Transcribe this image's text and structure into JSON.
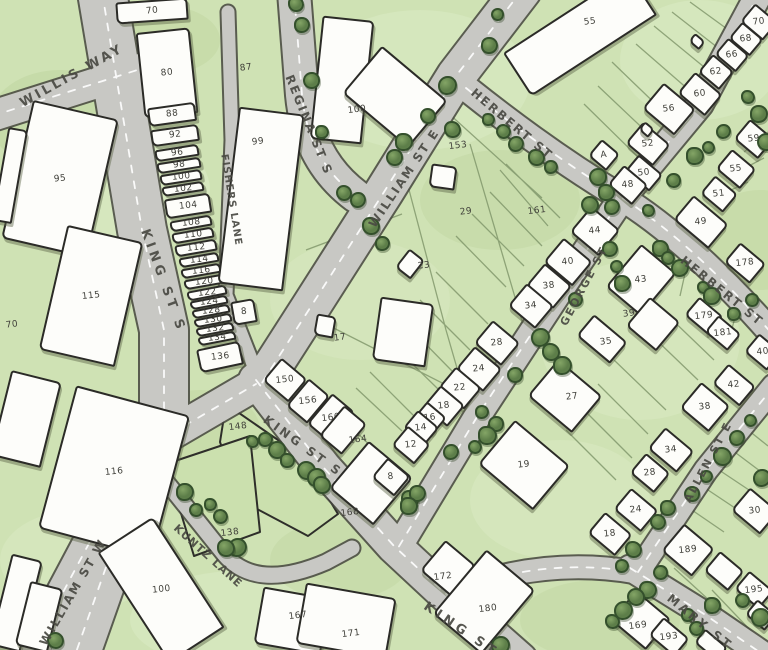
{
  "map": {
    "colors": {
      "background": "#cfe2b4",
      "grass_light": "#dcebc6",
      "grass_dark": "#bed49e",
      "road_fill": "#c8c8c4",
      "road_casing": "#45453e",
      "road_dash": "#ffffff",
      "lot_line": "#7d9468",
      "building_fill": "#fdfdfa",
      "building_outline": "#2b2b27",
      "tree_fill": "#5d7e49",
      "tree_outline": "#34502c",
      "number_label": "#3f3f39",
      "street_label": "#4a4a43"
    },
    "street_labels": [
      {
        "text": "WILLIS WAY",
        "x": 72,
        "y": 76,
        "rot": -29,
        "size": 13,
        "spacing": 3
      },
      {
        "text": "KING ST S",
        "x": 163,
        "y": 281,
        "rot": 70,
        "size": 13,
        "spacing": 4
      },
      {
        "text": "FISHERS LANE",
        "x": 231,
        "y": 200,
        "rot": 81,
        "size": 10,
        "spacing": 1
      },
      {
        "text": "REGINA ST S",
        "x": 309,
        "y": 125,
        "rot": 68,
        "size": 12,
        "spacing": 2
      },
      {
        "text": "WILLIAM ST E",
        "x": 404,
        "y": 178,
        "rot": -56,
        "size": 12,
        "spacing": 2
      },
      {
        "text": "HERBERT ST",
        "x": 512,
        "y": 124,
        "rot": 40,
        "size": 12,
        "spacing": 2
      },
      {
        "text": "HERBERT ST",
        "x": 722,
        "y": 291,
        "rot": 39,
        "size": 12,
        "spacing": 2
      },
      {
        "text": "GEORGE ST",
        "x": 584,
        "y": 286,
        "rot": -62,
        "size": 11,
        "spacing": 2
      },
      {
        "text": "KING ST S",
        "x": 303,
        "y": 446,
        "rot": 36,
        "size": 12,
        "spacing": 3
      },
      {
        "text": "KING ST S",
        "x": 470,
        "y": 636,
        "rot": 34,
        "size": 13,
        "spacing": 4
      },
      {
        "text": "ALLEN ST E",
        "x": 708,
        "y": 462,
        "rot": -62,
        "size": 11,
        "spacing": 2
      },
      {
        "text": "MARY ST",
        "x": 700,
        "y": 622,
        "rot": 39,
        "size": 12,
        "spacing": 3
      },
      {
        "text": "WILLIAM ST W",
        "x": 73,
        "y": 592,
        "rot": -60,
        "size": 12,
        "spacing": 2
      },
      {
        "text": "KUNTZ LANE",
        "x": 208,
        "y": 556,
        "rot": 42,
        "size": 11,
        "spacing": 1
      }
    ],
    "parcel_labels": [
      {
        "text": "70",
        "x": 12,
        "y": 325
      },
      {
        "text": "87",
        "x": 246,
        "y": 68
      },
      {
        "text": "29",
        "x": 466,
        "y": 212
      },
      {
        "text": "153",
        "x": 458,
        "y": 146
      },
      {
        "text": "161",
        "x": 537,
        "y": 211
      },
      {
        "text": "148",
        "x": 238,
        "y": 427
      },
      {
        "text": "138",
        "x": 230,
        "y": 533
      },
      {
        "text": "164",
        "x": 358,
        "y": 440
      }
    ],
    "buildings": [
      {
        "x": 116,
        "y": 0,
        "w": 72,
        "h": 22,
        "r": -4,
        "n": "70"
      },
      {
        "x": 140,
        "y": 30,
        "w": 54,
        "h": 86,
        "r": -6,
        "n": "80"
      },
      {
        "x": 148,
        "y": 105,
        "w": 48,
        "h": 19,
        "r": -8,
        "n": "88"
      },
      {
        "x": 151,
        "y": 127,
        "w": 48,
        "h": 17,
        "r": -8,
        "n": "92"
      },
      {
        "x": 155,
        "y": 147,
        "w": 44,
        "h": 12,
        "r": -9,
        "n": "96"
      },
      {
        "x": 157,
        "y": 160,
        "w": 44,
        "h": 11,
        "r": -9,
        "n": "98"
      },
      {
        "x": 160,
        "y": 172,
        "w": 42,
        "h": 11,
        "r": -9,
        "n": "100"
      },
      {
        "x": 162,
        "y": 184,
        "w": 42,
        "h": 10,
        "r": -9,
        "n": "102"
      },
      {
        "x": 165,
        "y": 196,
        "w": 46,
        "h": 20,
        "r": -9,
        "n": "104"
      },
      {
        "x": 170,
        "y": 218,
        "w": 42,
        "h": 11,
        "r": -10,
        "n": "108"
      },
      {
        "x": 172,
        "y": 230,
        "w": 42,
        "h": 11,
        "r": -10,
        "n": "110"
      },
      {
        "x": 175,
        "y": 242,
        "w": 42,
        "h": 12,
        "r": -10,
        "n": "112"
      },
      {
        "x": 179,
        "y": 255,
        "w": 40,
        "h": 10,
        "r": -10,
        "n": "114"
      },
      {
        "x": 181,
        "y": 266,
        "w": 40,
        "h": 10,
        "r": -10,
        "n": "116"
      },
      {
        "x": 184,
        "y": 277,
        "w": 40,
        "h": 10,
        "r": -10,
        "n": "120"
      },
      {
        "x": 187,
        "y": 288,
        "w": 40,
        "h": 10,
        "r": -11,
        "n": "122"
      },
      {
        "x": 190,
        "y": 298,
        "w": 38,
        "h": 9,
        "r": -11,
        "n": "124"
      },
      {
        "x": 192,
        "y": 307,
        "w": 38,
        "h": 9,
        "r": -11,
        "n": "128"
      },
      {
        "x": 194,
        "y": 316,
        "w": 38,
        "h": 9,
        "r": -11,
        "n": "130"
      },
      {
        "x": 196,
        "y": 325,
        "w": 38,
        "h": 9,
        "r": -11,
        "n": "132"
      },
      {
        "x": 198,
        "y": 334,
        "w": 38,
        "h": 9,
        "r": -11,
        "n": "134"
      },
      {
        "x": 198,
        "y": 345,
        "w": 44,
        "h": 24,
        "r": -12,
        "n": "136"
      },
      {
        "x": 232,
        "y": 300,
        "w": 24,
        "h": 24,
        "r": -10,
        "n": "8"
      },
      {
        "x": 16,
        "y": 108,
        "w": 88,
        "h": 142,
        "r": 13,
        "n": "95"
      },
      {
        "x": 52,
        "y": 232,
        "w": 78,
        "h": 128,
        "r": 13,
        "n": "115"
      },
      {
        "x": 0,
        "y": 128,
        "w": 20,
        "h": 95,
        "r": 10
      },
      {
        "x": 0,
        "y": 375,
        "w": 52,
        "h": 88,
        "r": 14
      },
      {
        "x": 55,
        "y": 398,
        "w": 118,
        "h": 148,
        "r": 15,
        "n": "116"
      },
      {
        "x": 128,
        "y": 524,
        "w": 66,
        "h": 132,
        "r": -33,
        "n": "100"
      },
      {
        "x": 0,
        "y": 556,
        "w": 32,
        "h": 94,
        "r": 14
      },
      {
        "x": 22,
        "y": 584,
        "w": 34,
        "h": 66,
        "r": 14
      },
      {
        "x": 228,
        "y": 110,
        "w": 66,
        "h": 178,
        "r": 7,
        "n": "99",
        "lx": 258,
        "ly": 142
      },
      {
        "x": 316,
        "y": 18,
        "w": 52,
        "h": 124,
        "r": 6,
        "n": "100",
        "lx": 357,
        "ly": 110
      },
      {
        "x": 352,
        "y": 66,
        "w": 86,
        "h": 62,
        "r": 40
      },
      {
        "x": 505,
        "y": 8,
        "w": 150,
        "h": 52,
        "r": -33,
        "n": "55",
        "lx": 590,
        "ly": 22
      },
      {
        "x": 430,
        "y": 165,
        "w": 26,
        "h": 24,
        "r": 8
      },
      {
        "x": 400,
        "y": 252,
        "w": 20,
        "h": 24,
        "r": 38,
        "n": "23",
        "lx": 424,
        "ly": 266
      },
      {
        "x": 315,
        "y": 315,
        "w": 20,
        "h": 22,
        "r": 10,
        "n": "17",
        "lx": 340,
        "ly": 338
      },
      {
        "x": 376,
        "y": 300,
        "w": 54,
        "h": 64,
        "r": 8
      },
      {
        "x": 268,
        "y": 365,
        "w": 34,
        "h": 30,
        "r": 40,
        "n": "150"
      },
      {
        "x": 294,
        "y": 383,
        "w": 28,
        "h": 36,
        "r": 40,
        "n": "156"
      },
      {
        "x": 316,
        "y": 398,
        "w": 30,
        "h": 40,
        "r": 40,
        "n": "160"
      },
      {
        "x": 328,
        "y": 410,
        "w": 30,
        "h": 40,
        "r": 40
      },
      {
        "x": 342,
        "y": 452,
        "w": 58,
        "h": 62,
        "r": 40,
        "n": "168",
        "lx": 350,
        "ly": 513
      },
      {
        "x": 428,
        "y": 548,
        "w": 40,
        "h": 40,
        "r": 40,
        "n": "172",
        "lx": 443,
        "ly": 577
      },
      {
        "x": 452,
        "y": 560,
        "w": 64,
        "h": 84,
        "r": 40,
        "n": "180",
        "lx": 488,
        "ly": 609
      },
      {
        "x": 258,
        "y": 592,
        "w": 68,
        "h": 58,
        "r": 10,
        "n": "167",
        "lx": 298,
        "ly": 616
      },
      {
        "x": 300,
        "y": 590,
        "w": 92,
        "h": 62,
        "r": 10,
        "n": "171",
        "lx": 351,
        "ly": 634
      },
      {
        "x": 576,
        "y": 214,
        "w": 38,
        "h": 34,
        "r": 40,
        "n": "44"
      },
      {
        "x": 549,
        "y": 246,
        "w": 38,
        "h": 32,
        "r": 40,
        "n": "40"
      },
      {
        "x": 531,
        "y": 271,
        "w": 36,
        "h": 30,
        "r": 40,
        "n": "38"
      },
      {
        "x": 513,
        "y": 291,
        "w": 36,
        "h": 30,
        "r": 40,
        "n": "34"
      },
      {
        "x": 479,
        "y": 328,
        "w": 36,
        "h": 30,
        "r": 40,
        "n": "28"
      },
      {
        "x": 461,
        "y": 354,
        "w": 36,
        "h": 30,
        "r": 40,
        "n": "24"
      },
      {
        "x": 443,
        "y": 374,
        "w": 34,
        "h": 28,
        "r": 40,
        "n": "22"
      },
      {
        "x": 428,
        "y": 392,
        "w": 32,
        "h": 28,
        "r": 40,
        "n": "18"
      },
      {
        "x": 417,
        "y": 407,
        "w": 26,
        "h": 22,
        "r": 40,
        "n": "16"
      },
      {
        "x": 407,
        "y": 416,
        "w": 28,
        "h": 24,
        "r": 40,
        "n": "14"
      },
      {
        "x": 396,
        "y": 432,
        "w": 30,
        "h": 26,
        "r": 40,
        "n": "12"
      },
      {
        "x": 376,
        "y": 464,
        "w": 30,
        "h": 26,
        "r": 40,
        "n": "8"
      },
      {
        "x": 488,
        "y": 436,
        "w": 72,
        "h": 58,
        "r": 40,
        "n": "19"
      },
      {
        "x": 618,
        "y": 252,
        "w": 46,
        "h": 56,
        "r": 40,
        "n": "43"
      },
      {
        "x": 633,
        "y": 305,
        "w": 40,
        "h": 38,
        "r": 40,
        "n": "39",
        "lx": 629,
        "ly": 314
      },
      {
        "x": 580,
        "y": 325,
        "w": 44,
        "h": 28,
        "r": 40,
        "n": "35",
        "lx": 606,
        "ly": 342
      },
      {
        "x": 536,
        "y": 372,
        "w": 58,
        "h": 48,
        "r": 40,
        "n": "27",
        "lx": 572,
        "ly": 397
      },
      {
        "x": 744,
        "y": 10,
        "w": 30,
        "h": 24,
        "r": 40,
        "n": "70"
      },
      {
        "x": 732,
        "y": 28,
        "w": 28,
        "h": 22,
        "r": 40,
        "n": "68"
      },
      {
        "x": 718,
        "y": 44,
        "w": 28,
        "h": 22,
        "r": 40,
        "n": "66"
      },
      {
        "x": 702,
        "y": 60,
        "w": 28,
        "h": 24,
        "r": 40,
        "n": "62"
      },
      {
        "x": 682,
        "y": 80,
        "w": 36,
        "h": 28,
        "r": 40,
        "n": "60"
      },
      {
        "x": 648,
        "y": 92,
        "w": 42,
        "h": 34,
        "r": 40,
        "n": "56"
      },
      {
        "x": 630,
        "y": 130,
        "w": 36,
        "h": 28,
        "r": 40,
        "n": "52"
      },
      {
        "x": 628,
        "y": 162,
        "w": 32,
        "h": 22,
        "r": 40,
        "n": "50"
      },
      {
        "x": 612,
        "y": 172,
        "w": 32,
        "h": 26,
        "r": 40,
        "n": "48"
      },
      {
        "x": 738,
        "y": 126,
        "w": 32,
        "h": 26,
        "r": 40,
        "n": "59"
      },
      {
        "x": 720,
        "y": 156,
        "w": 32,
        "h": 26,
        "r": 40,
        "n": "55"
      },
      {
        "x": 704,
        "y": 182,
        "w": 30,
        "h": 24,
        "r": 40,
        "n": "51"
      },
      {
        "x": 690,
        "y": 36,
        "w": 14,
        "h": 11,
        "r": 40
      },
      {
        "x": 640,
        "y": 124,
        "w": 13,
        "h": 11,
        "r": 40
      },
      {
        "x": 592,
        "y": 144,
        "w": 24,
        "h": 22,
        "r": 40,
        "n": "A"
      },
      {
        "x": 678,
        "y": 206,
        "w": 46,
        "h": 32,
        "r": 40,
        "n": "49"
      },
      {
        "x": 728,
        "y": 250,
        "w": 34,
        "h": 26,
        "r": 40,
        "n": "178"
      },
      {
        "x": 688,
        "y": 304,
        "w": 32,
        "h": 24,
        "r": 40,
        "n": "179"
      },
      {
        "x": 708,
        "y": 322,
        "w": 30,
        "h": 22,
        "r": 40,
        "n": "181"
      },
      {
        "x": 748,
        "y": 340,
        "w": 30,
        "h": 24,
        "r": 40,
        "n": "40"
      },
      {
        "x": 716,
        "y": 372,
        "w": 36,
        "h": 26,
        "r": 40,
        "n": "42"
      },
      {
        "x": 686,
        "y": 390,
        "w": 38,
        "h": 34,
        "r": 40,
        "n": "38"
      },
      {
        "x": 652,
        "y": 436,
        "w": 38,
        "h": 28,
        "r": 40,
        "n": "34"
      },
      {
        "x": 634,
        "y": 460,
        "w": 32,
        "h": 26,
        "r": 40,
        "n": "28"
      },
      {
        "x": 736,
        "y": 496,
        "w": 38,
        "h": 30,
        "r": 40,
        "n": "30"
      },
      {
        "x": 618,
        "y": 496,
        "w": 36,
        "h": 28,
        "r": 40,
        "n": "24"
      },
      {
        "x": 592,
        "y": 520,
        "w": 36,
        "h": 28,
        "r": 40,
        "n": "18"
      },
      {
        "x": 668,
        "y": 532,
        "w": 40,
        "h": 36,
        "r": 40,
        "n": "189"
      },
      {
        "x": 708,
        "y": 558,
        "w": 32,
        "h": 26,
        "r": 40
      },
      {
        "x": 738,
        "y": 578,
        "w": 32,
        "h": 24,
        "r": 40,
        "n": "195"
      },
      {
        "x": 618,
        "y": 600,
        "w": 46,
        "h": 40,
        "r": 40,
        "n": "169",
        "lx": 638,
        "ly": 626
      },
      {
        "x": 652,
        "y": 625,
        "w": 34,
        "h": 24,
        "r": 40,
        "n": "193"
      },
      {
        "x": 696,
        "y": 636,
        "w": 30,
        "h": 18,
        "r": 40
      },
      {
        "x": 748,
        "y": 605,
        "w": 26,
        "h": 20,
        "r": 40
      }
    ],
    "trees": [
      [
        296,
        4
      ],
      [
        302,
        25
      ],
      [
        311,
        80
      ],
      [
        322,
        132
      ],
      [
        344,
        193
      ],
      [
        358,
        200
      ],
      [
        371,
        226
      ],
      [
        382,
        243
      ],
      [
        394,
        157
      ],
      [
        404,
        142
      ],
      [
        428,
        116
      ],
      [
        447,
        85
      ],
      [
        452,
        129
      ],
      [
        489,
        45
      ],
      [
        497,
        14
      ],
      [
        488,
        119
      ],
      [
        503,
        131
      ],
      [
        516,
        144
      ],
      [
        536,
        157
      ],
      [
        551,
        167
      ],
      [
        598,
        177
      ],
      [
        606,
        192
      ],
      [
        590,
        205
      ],
      [
        612,
        207
      ],
      [
        648,
        210
      ],
      [
        610,
        249
      ],
      [
        616,
        266
      ],
      [
        622,
        283
      ],
      [
        575,
        299
      ],
      [
        540,
        337
      ],
      [
        551,
        352
      ],
      [
        562,
        365
      ],
      [
        673,
        180
      ],
      [
        695,
        156
      ],
      [
        708,
        147
      ],
      [
        723,
        131
      ],
      [
        748,
        97
      ],
      [
        759,
        114
      ],
      [
        766,
        142
      ],
      [
        660,
        248
      ],
      [
        668,
        258
      ],
      [
        680,
        268
      ],
      [
        703,
        287
      ],
      [
        712,
        296
      ],
      [
        752,
        300
      ],
      [
        734,
        314
      ],
      [
        750,
        420
      ],
      [
        737,
        438
      ],
      [
        722,
        456
      ],
      [
        706,
        476
      ],
      [
        692,
        494
      ],
      [
        668,
        508
      ],
      [
        658,
        522
      ],
      [
        762,
        478
      ],
      [
        633,
        549
      ],
      [
        622,
        566
      ],
      [
        660,
        572
      ],
      [
        648,
        590
      ],
      [
        636,
        597
      ],
      [
        623,
        610
      ],
      [
        612,
        621
      ],
      [
        688,
        615
      ],
      [
        696,
        628
      ],
      [
        712,
        605
      ],
      [
        742,
        600
      ],
      [
        760,
        617
      ],
      [
        252,
        441
      ],
      [
        265,
        439
      ],
      [
        277,
        450
      ],
      [
        287,
        460
      ],
      [
        306,
        470
      ],
      [
        316,
        477
      ],
      [
        322,
        485
      ],
      [
        185,
        492
      ],
      [
        196,
        510
      ],
      [
        210,
        504
      ],
      [
        220,
        516
      ],
      [
        237,
        547
      ],
      [
        226,
        548
      ],
      [
        482,
        412
      ],
      [
        496,
        424
      ],
      [
        487,
        435
      ],
      [
        475,
        447
      ],
      [
        451,
        452
      ],
      [
        410,
        499
      ],
      [
        417,
        493
      ],
      [
        515,
        375
      ],
      [
        409,
        506
      ],
      [
        55,
        640
      ],
      [
        500,
        645
      ]
    ]
  }
}
